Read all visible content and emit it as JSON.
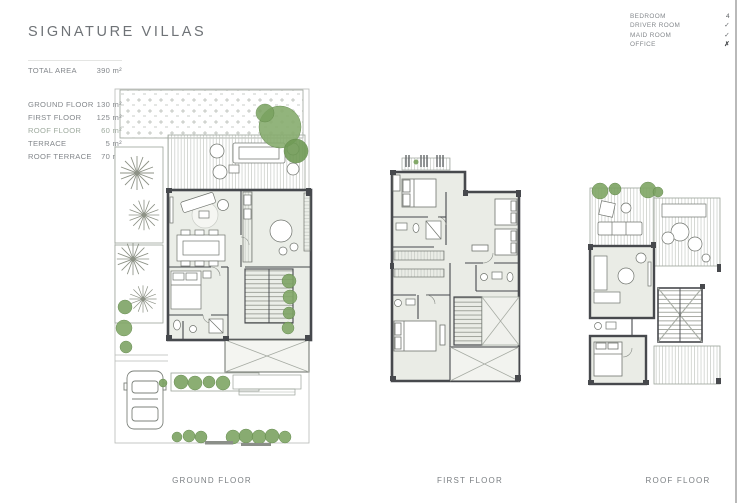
{
  "header": {
    "title": "SIGNATURE VILLAS"
  },
  "area_summary": {
    "total": {
      "label": "TOTAL AREA",
      "value": "390 m²"
    },
    "rows": [
      {
        "label": "GROUND FLOOR",
        "value": "130 m²"
      },
      {
        "label": "FIRST FLOOR",
        "value": "125 m²"
      },
      {
        "label": "ROOF FLOOR",
        "value": "60 m²"
      },
      {
        "label": "TERRACE",
        "value": "5 m²"
      },
      {
        "label": "ROOF TERRACE",
        "value": "70 m²"
      }
    ]
  },
  "features": {
    "rows": [
      {
        "label": "BEDROOM",
        "value": "4"
      },
      {
        "label": "DRIVER ROOM",
        "value": "✓"
      },
      {
        "label": "MAID ROOM",
        "value": "✓"
      },
      {
        "label": "OFFICE",
        "value": "✗"
      }
    ]
  },
  "plans": [
    {
      "label": "GROUND FLOOR"
    },
    {
      "label": "FIRST FLOOR"
    },
    {
      "label": "ROOF FLOOR"
    }
  ],
  "colors": {
    "plant_green": "#82a868",
    "wall_gray": "#46494d",
    "hatch_gray": "#c6cac4",
    "text_gray": "#83878b"
  }
}
